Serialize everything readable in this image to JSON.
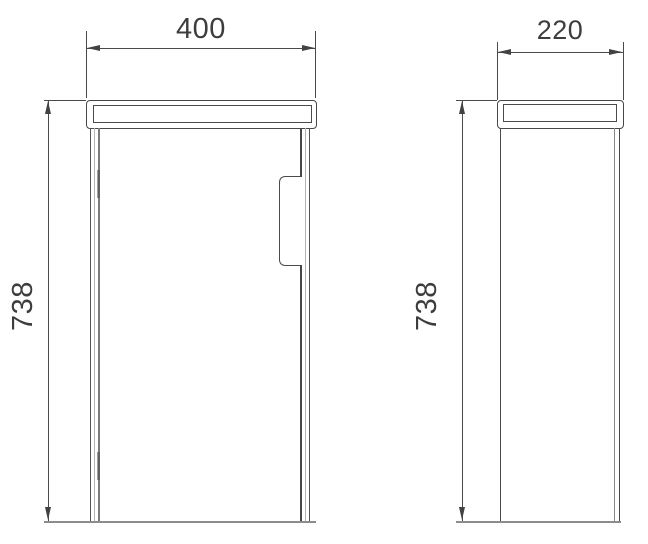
{
  "dimensions": {
    "front_width": "400",
    "side_depth": "220",
    "front_height": "738",
    "side_height": "738"
  },
  "colors": {
    "outline": "#4a4a4a",
    "dimension_text": "#3d3d3d",
    "door_gap_line": "#7a7a7a",
    "bottom_edge_line": "#8c8c8c",
    "background": "#ffffff"
  }
}
